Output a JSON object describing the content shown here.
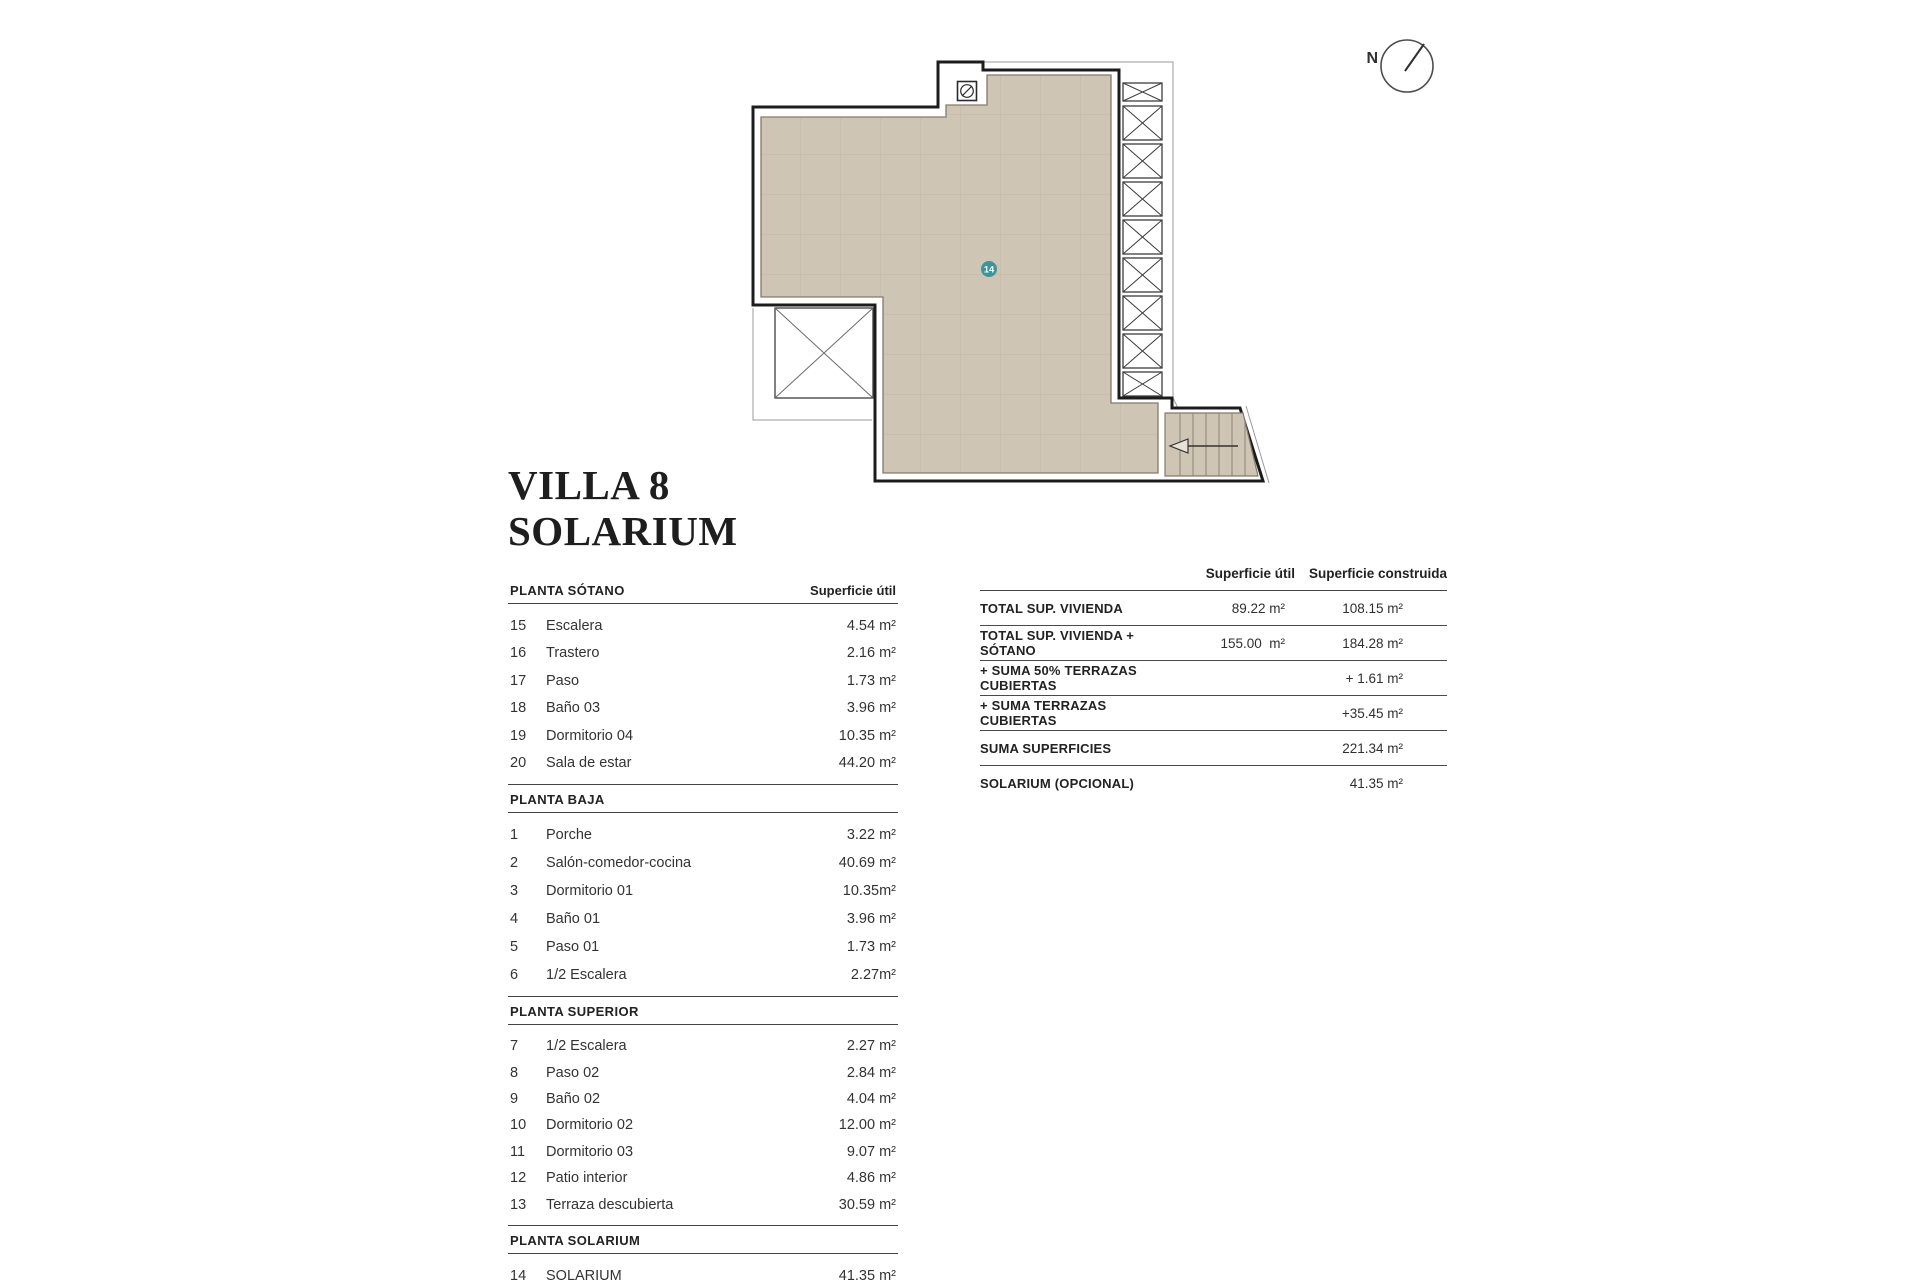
{
  "title": {
    "line1": "VILLA 8",
    "line2": "SOLARIUM"
  },
  "plan": {
    "compass_label": "N",
    "room_label": "14",
    "badge_color": "#3d949b",
    "floor_color": "#cfc5b4",
    "grid_color": "#c2b7a6"
  },
  "left_table": {
    "area_header": "Superficie útil",
    "sections": [
      {
        "name": "PLANTA SÓTANO",
        "rows": [
          [
            "15",
            "Escalera",
            "4.54 m²"
          ],
          [
            "16",
            "Trastero",
            "2.16 m²"
          ],
          [
            "17",
            "Paso",
            "1.73 m²"
          ],
          [
            "18",
            "Baño 03",
            "3.96 m²"
          ],
          [
            "19",
            "Dormitorio 04",
            "10.35 m²"
          ],
          [
            "20",
            "Sala de estar",
            "44.20 m²"
          ]
        ]
      },
      {
        "name": "PLANTA BAJA",
        "rows": [
          [
            "1",
            "Porche",
            "3.22 m²"
          ],
          [
            "2",
            "Salón-comedor-cocina",
            "40.69 m²"
          ],
          [
            "3",
            "Dormitorio 01",
            "10.35m²"
          ],
          [
            "4",
            "Baño 01",
            "3.96 m²"
          ],
          [
            "5",
            "Paso 01",
            "1.73 m²"
          ],
          [
            "6",
            "1/2 Escalera",
            "2.27m²"
          ]
        ]
      },
      {
        "name": "PLANTA SUPERIOR",
        "rows": [
          [
            "7",
            "1/2 Escalera",
            "2.27 m²"
          ],
          [
            "8",
            "Paso 02",
            "2.84 m²"
          ],
          [
            "9",
            "Baño 02",
            "4.04 m²"
          ],
          [
            "10",
            "Dormitorio 02",
            "12.00 m²"
          ],
          [
            "11",
            "Dormitorio 03",
            "9.07 m²"
          ],
          [
            "12",
            "Patio interior",
            "4.86 m²"
          ],
          [
            "13",
            "Terraza descubierta",
            "30.59 m²"
          ]
        ]
      },
      {
        "name": "PLANTA SOLARIUM",
        "rows": [
          [
            "14",
            "SOLARIUM",
            "41.35 m²"
          ]
        ]
      }
    ]
  },
  "summary_table": {
    "col1_header": "Superficie útil",
    "col2_header": "Superficie construida",
    "rows": [
      {
        "label": "TOTAL SUP. VIVIENDA",
        "util": "89.22 m²",
        "construida": "108.15 m²"
      },
      {
        "label": "TOTAL SUP. VIVIENDA + SÓTANO",
        "util": "155.00  m²",
        "construida": "184.28 m²"
      },
      {
        "label": "+ SUMA 50% TERRAZAS CUBIERTAS",
        "util": "",
        "construida": "+ 1.61 m²"
      },
      {
        "label": "+ SUMA TERRAZAS CUBIERTAS",
        "util": "",
        "construida": "+35.45 m²"
      },
      {
        "label": "SUMA SUPERFICIES",
        "util": "",
        "construida": "221.34 m²"
      },
      {
        "label": "SOLARIUM (OPCIONAL)",
        "util": "",
        "construida": "41.35 m²"
      }
    ]
  }
}
